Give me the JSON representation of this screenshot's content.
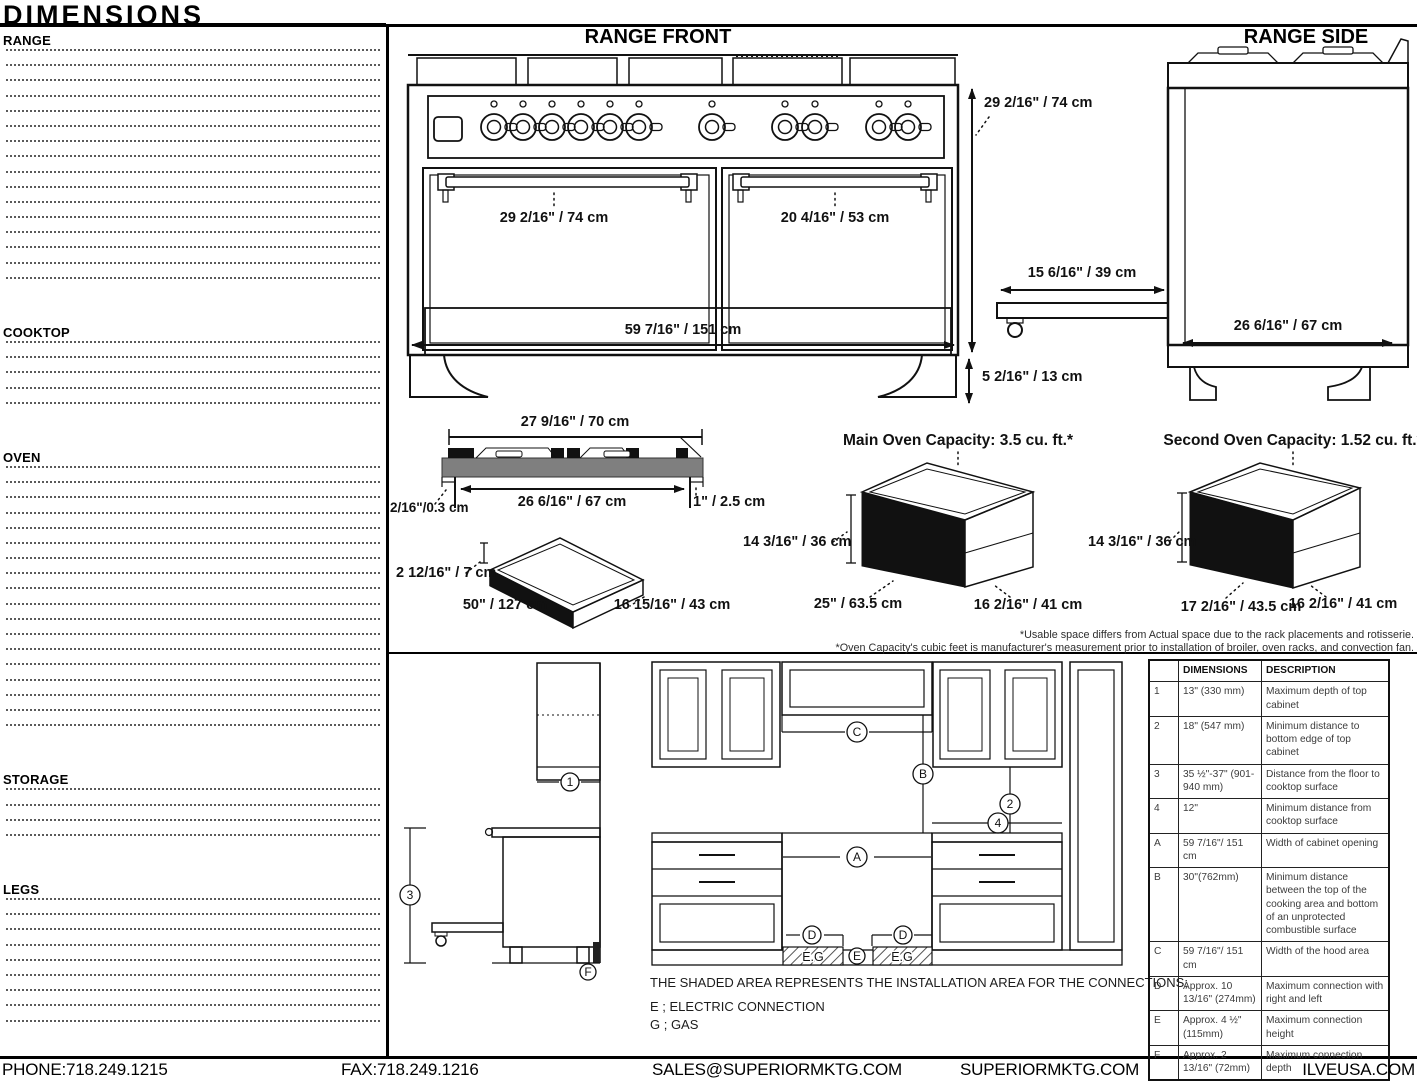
{
  "page_title": "DIMENSIONS",
  "sections": [
    {
      "heading": "RANGE",
      "rows": [
        {
          "label": "Range Width",
          "value": "59 7/16\" / 151 cm"
        },
        {
          "label": "Range Height without legs",
          "value": "29 2/16\" / 74 cm"
        },
        {
          "label": "Range Min. Height with legs",
          "value": "34 4/16\" / 87 cm"
        },
        {
          "label": "Range Max Height with legs",
          "value": "34 4/16\" / 87 cm"
        },
        {
          "label": "Range Depth",
          "value": "26 6/16\" / 67 cm"
        },
        {
          "label": "Backsplash Width",
          "value": "59 7/16\" / 151 cm"
        },
        {
          "label": "Backsplash Height",
          "value": "2 6/16\" / 6 cm"
        },
        {
          "label": "Backsplash Depth",
          "value": "9/16\" / 1.5 cm"
        },
        {
          "label": "Main Oven Handle Length",
          "value": "29 2/16\" / 74 cm"
        },
        {
          "label": "Second Oven Handle Length",
          "value": "20 4/16\" / 53 cm"
        },
        {
          "label": "Main Oven Handle Depth over Range",
          "value": "2 3/16\"/ 5.5 cm"
        },
        {
          "label": "Second Oven Handle Depth over Range",
          "value": "2 3/16\"/ 5.5 cm"
        },
        {
          "label": "Power from bottom",
          "value": "9 7/16\" / 24 cm"
        },
        {
          "label": "Power from right side",
          "value": "10 4/16\" / 26 cm"
        },
        {
          "label": "Gas connector from bottom",
          "value": "5 2/16\" / 13 cm"
        },
        {
          "label": "Gas connector from right side",
          "value": "6 5/16\" / 16 cm"
        }
      ]
    },
    {
      "heading": "COOKTOP",
      "rows": [
        {
          "label": "Cooktop Width",
          "value": "59 7/16\" / 151 cm"
        },
        {
          "label": "Cooktop Depth",
          "value": "27 9/16\" / 70 cm"
        },
        {
          "label": "Cooktop Heigth",
          "value": "1 9/16\" / 4 cm"
        },
        {
          "label": "Cooktop Front Lip Depth over Range",
          "value": "2/16\" / 0.3 cm"
        },
        {
          "label": "Cooktop Back Lip Depth over Range",
          "value": "1\" / 2.5 cm"
        }
      ]
    },
    {
      "heading": "OVEN",
      "rows": [
        {
          "label": "Main Oven Capacity",
          "value": "3.5 cu. ft."
        },
        {
          "label": "Second Oven Capacity",
          "value": "1.52 cu. ft."
        },
        {
          "label": "Main Oven Depth with Door Open 90°",
          "value": "15 6/16\" / 39 cm"
        },
        {
          "label": "Second Oven Depth with Door Open 90°",
          "value": "15 6/16\" / 39 cm"
        },
        {
          "label": "Main Oven Interior Width (Actual)",
          "value": "25\" / 63.5 cm"
        },
        {
          "label": "Main Oven Interior Heigth (Actual)",
          "value": "14 3/16\" / 36 cm"
        },
        {
          "label": "Main Oven Interior Depth (Actual)",
          "value": "16 2/16\" / 41 cm"
        },
        {
          "label": "Main Oven Interior Width (Usable)",
          "value": "23 4/16\" / 59 cm"
        },
        {
          "label": "Main Oven Interior Height (Usable)",
          "value": "14 3/16\" / 36 cm"
        },
        {
          "label": "Main Oven Interior Depth (Usable)",
          "value": "16 2/16\" / 41 cm"
        },
        {
          "label": "Second Oven Interior Width (Actual)",
          "value": "17 2/16\" / 43.5 cm"
        },
        {
          "label": "Second Oven Interior Heigth (Actual)",
          "value": "14 3/16\" / 36 cm"
        },
        {
          "label": "Second Oven Interior Depth (Actual)",
          "value": "16 2/16\" / 41 cm"
        },
        {
          "label": "Second Oven Interior Width (Usable)",
          "value": "15 6/16\" / 39 cm"
        },
        {
          "label": "Second Oven Interior Height (Usable)",
          "value": "14 3/16\" / 36 cm"
        },
        {
          "label": "Second Oven Interior Depth (Usable)",
          "value": "16 2/16\" / 41 cm"
        },
        {
          "label": "Height between Rack Plates",
          "value": "1 9/16\" / 4 cm"
        },
        {
          "label": "Height between lowest and highest rack",
          "value": "7 14/16\" / 20 cm"
        }
      ]
    },
    {
      "heading": "STORAGE",
      "rows": [
        {
          "label": "Type",
          "value": "Warming"
        },
        {
          "label": "Width",
          "value": "50\" / 127 cm"
        },
        {
          "label": "Height",
          "value": "2 12/16\" / 7 cm"
        },
        {
          "label": "Depth",
          "value": "16 15/16\" / 43 cm"
        }
      ]
    },
    {
      "heading": "LEGS",
      "rows": [
        {
          "label": "Range Leg Type",
          "value": "Plinth"
        },
        {
          "label": "Range Leg Number",
          "value": "4"
        },
        {
          "label": "Adjustable Range Legs",
          "value": "No"
        },
        {
          "label": "Levelable Range Legs",
          "value": "Yes"
        },
        {
          "label": "Range Leg Min. Heigth",
          "value": "5 2/16\" / 13 cm"
        },
        {
          "label": "Range Leg Max. Heigth",
          "value": "5 2/16\" / 13 cm"
        },
        {
          "label": "Space Between Leg and Range (Side)",
          "value": "0\" / 0 cm"
        },
        {
          "label": "Space Between Leg and Range (Front)",
          "value": "0\" / 0 cm"
        },
        {
          "label": "Space Between Leg and Range (Back)",
          "value": "0\" / 0 cm"
        }
      ]
    }
  ],
  "drawings": {
    "front": {
      "title": "RANGE FRONT",
      "main_handle": "29 2/16\" / 74 cm",
      "second_handle": "20 4/16\" / 53 cm",
      "width": "59 7/16\" / 151 cm",
      "body_height": "29 2/16\" / 74 cm",
      "leg_height": "5 2/16\" / 13 cm"
    },
    "side": {
      "title": "RANGE SIDE",
      "door_open": "15 6/16\" / 39 cm",
      "depth": "26 6/16\" / 67 cm"
    },
    "cooktop": {
      "top_width": "27 9/16\" / 70 cm",
      "bottom_width": "26 6/16\" / 67 cm",
      "front_lip": "2/16\"/0.3 cm",
      "back_lip": "1\" / 2.5 cm"
    },
    "storage": {
      "height": "2 12/16\" / 7 cm",
      "width": "50\" / 127 cm",
      "depth": "16 15/16\" / 43 cm"
    },
    "main_oven": {
      "title": "Main Oven Capacity: 3.5 cu. ft.*",
      "height": "14 3/16\" / 36 cm",
      "width": "25\" / 63.5 cm",
      "depth": "16 2/16\" / 41 cm"
    },
    "second_oven": {
      "title": "Second Oven Capacity: 1.52 cu. ft.*",
      "height": "14 3/16\" / 36 cm",
      "width": "17 2/16\" / 43.5 cm",
      "depth": "16 2/16\" / 41 cm"
    }
  },
  "footnotes": [
    "*Usable space differs from Actual space due to the rack placements and rotisserie.",
    "*Oven Capacity's cubic feet is manufacturer's measurement prior to installation of broiler, oven racks, and convection fan."
  ],
  "installation": {
    "callouts": {
      "n1": "1",
      "n2": "2",
      "n3": "3",
      "n4": "4",
      "A": "A",
      "B": "B",
      "C": "C",
      "D": "D",
      "E": "E",
      "F": "F",
      "eg": "E.G"
    },
    "table": {
      "col_key": "",
      "col_dimensions": "DIMENSIONS",
      "col_description": "DESCRIPTION",
      "rows": [
        {
          "key": "1",
          "dimensions": "13\" (330 mm)",
          "description": "Maximum depth of top cabinet"
        },
        {
          "key": "2",
          "dimensions": "18\" (547 mm)",
          "description": "Minimum distance to bottom edge of top cabinet"
        },
        {
          "key": "3",
          "dimensions": "35 ½\"-37\" (901-940 mm)",
          "description": "Distance from the floor to cooktop surface"
        },
        {
          "key": "4",
          "dimensions": "12\"",
          "description": "Minimum distance from cooktop surface"
        },
        {
          "key": "A",
          "dimensions": "59 7/16\"/ 151 cm",
          "description": "Width of cabinet opening"
        },
        {
          "key": "B",
          "dimensions": "30\"(762mm)",
          "description": "Minimum distance between the top of the cooking area and bottom of an unprotected combustible surface"
        },
        {
          "key": "C",
          "dimensions": "59 7/16\"/ 151 cm",
          "description": "Width of the hood area"
        },
        {
          "key": "D",
          "dimensions": "Approx. 10 13/16\" (274mm)",
          "description": "Maximum connection with right and left"
        },
        {
          "key": "E",
          "dimensions": "Approx. 4 ½\" (115mm)",
          "description": "Maximum connection height"
        },
        {
          "key": "F",
          "dimensions": "Approx. 2 13/16\" (72mm)",
          "description": "Maximum connection depth"
        }
      ]
    },
    "notes": [
      "THE SHADED AREA REPRESENTS THE INSTALLATION AREA FOR THE CONNECTIONS;",
      "E ; ELECTRIC CONNECTION",
      "G ; GAS"
    ]
  },
  "footer": {
    "phone": "PHONE:718.249.1215",
    "fax": "FAX:718.249.1216",
    "email": "SALES@SUPERIORMKTG.COM",
    "website": "SUPERIORMKTG.COM",
    "brand": "ILVEUSA.COM"
  }
}
